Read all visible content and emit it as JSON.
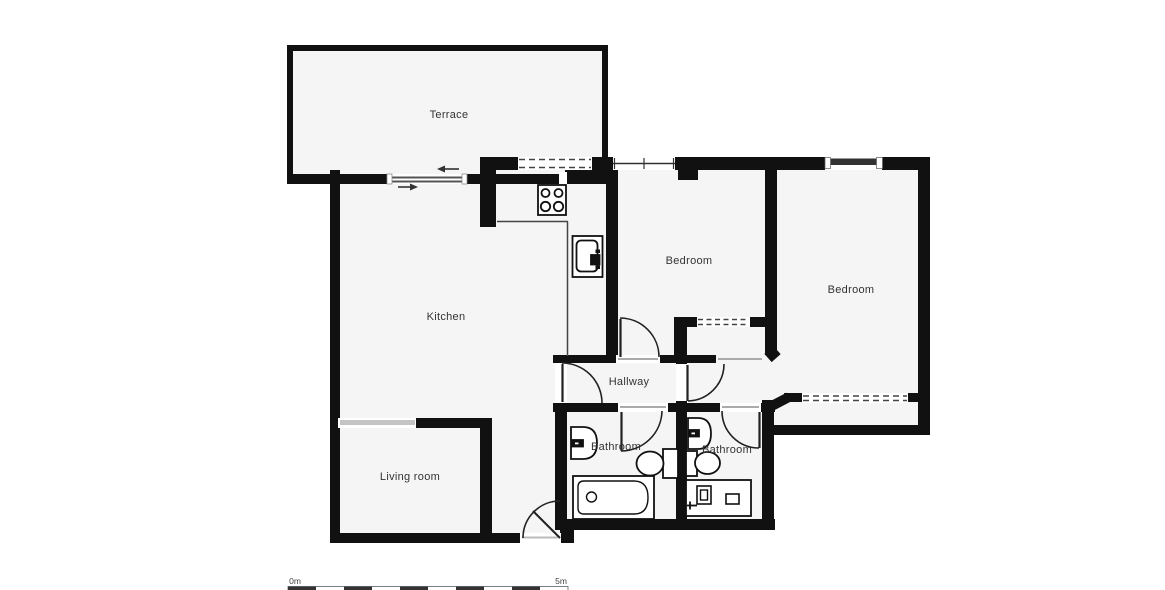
{
  "rooms": {
    "terrace": {
      "label": "Terrace"
    },
    "kitchen": {
      "label": "Kitchen"
    },
    "bedroom1": {
      "label": "Bedroom"
    },
    "bedroom2": {
      "label": "Bedroom"
    },
    "hallway": {
      "label": "Hallway"
    },
    "bathroom1": {
      "label": "Bathroom"
    },
    "bathroom2": {
      "label": "Bathroom"
    },
    "living_room": {
      "label": "Living room"
    }
  },
  "scale_bar": {
    "start_label": "0m",
    "end_label": "5m"
  },
  "fixtures": [
    "stove-icon",
    "kitchen-sink-icon",
    "washbasin-icon",
    "washbasin-icon",
    "toilet-icon",
    "toilet-icon",
    "bathtub-icon",
    "shower-unit-icon",
    "sliding-door-icon"
  ],
  "colors": {
    "wall": "#111111",
    "room_fill": "#f5f5f5",
    "label": "#333333",
    "window_gray": "#c4c4c4"
  }
}
